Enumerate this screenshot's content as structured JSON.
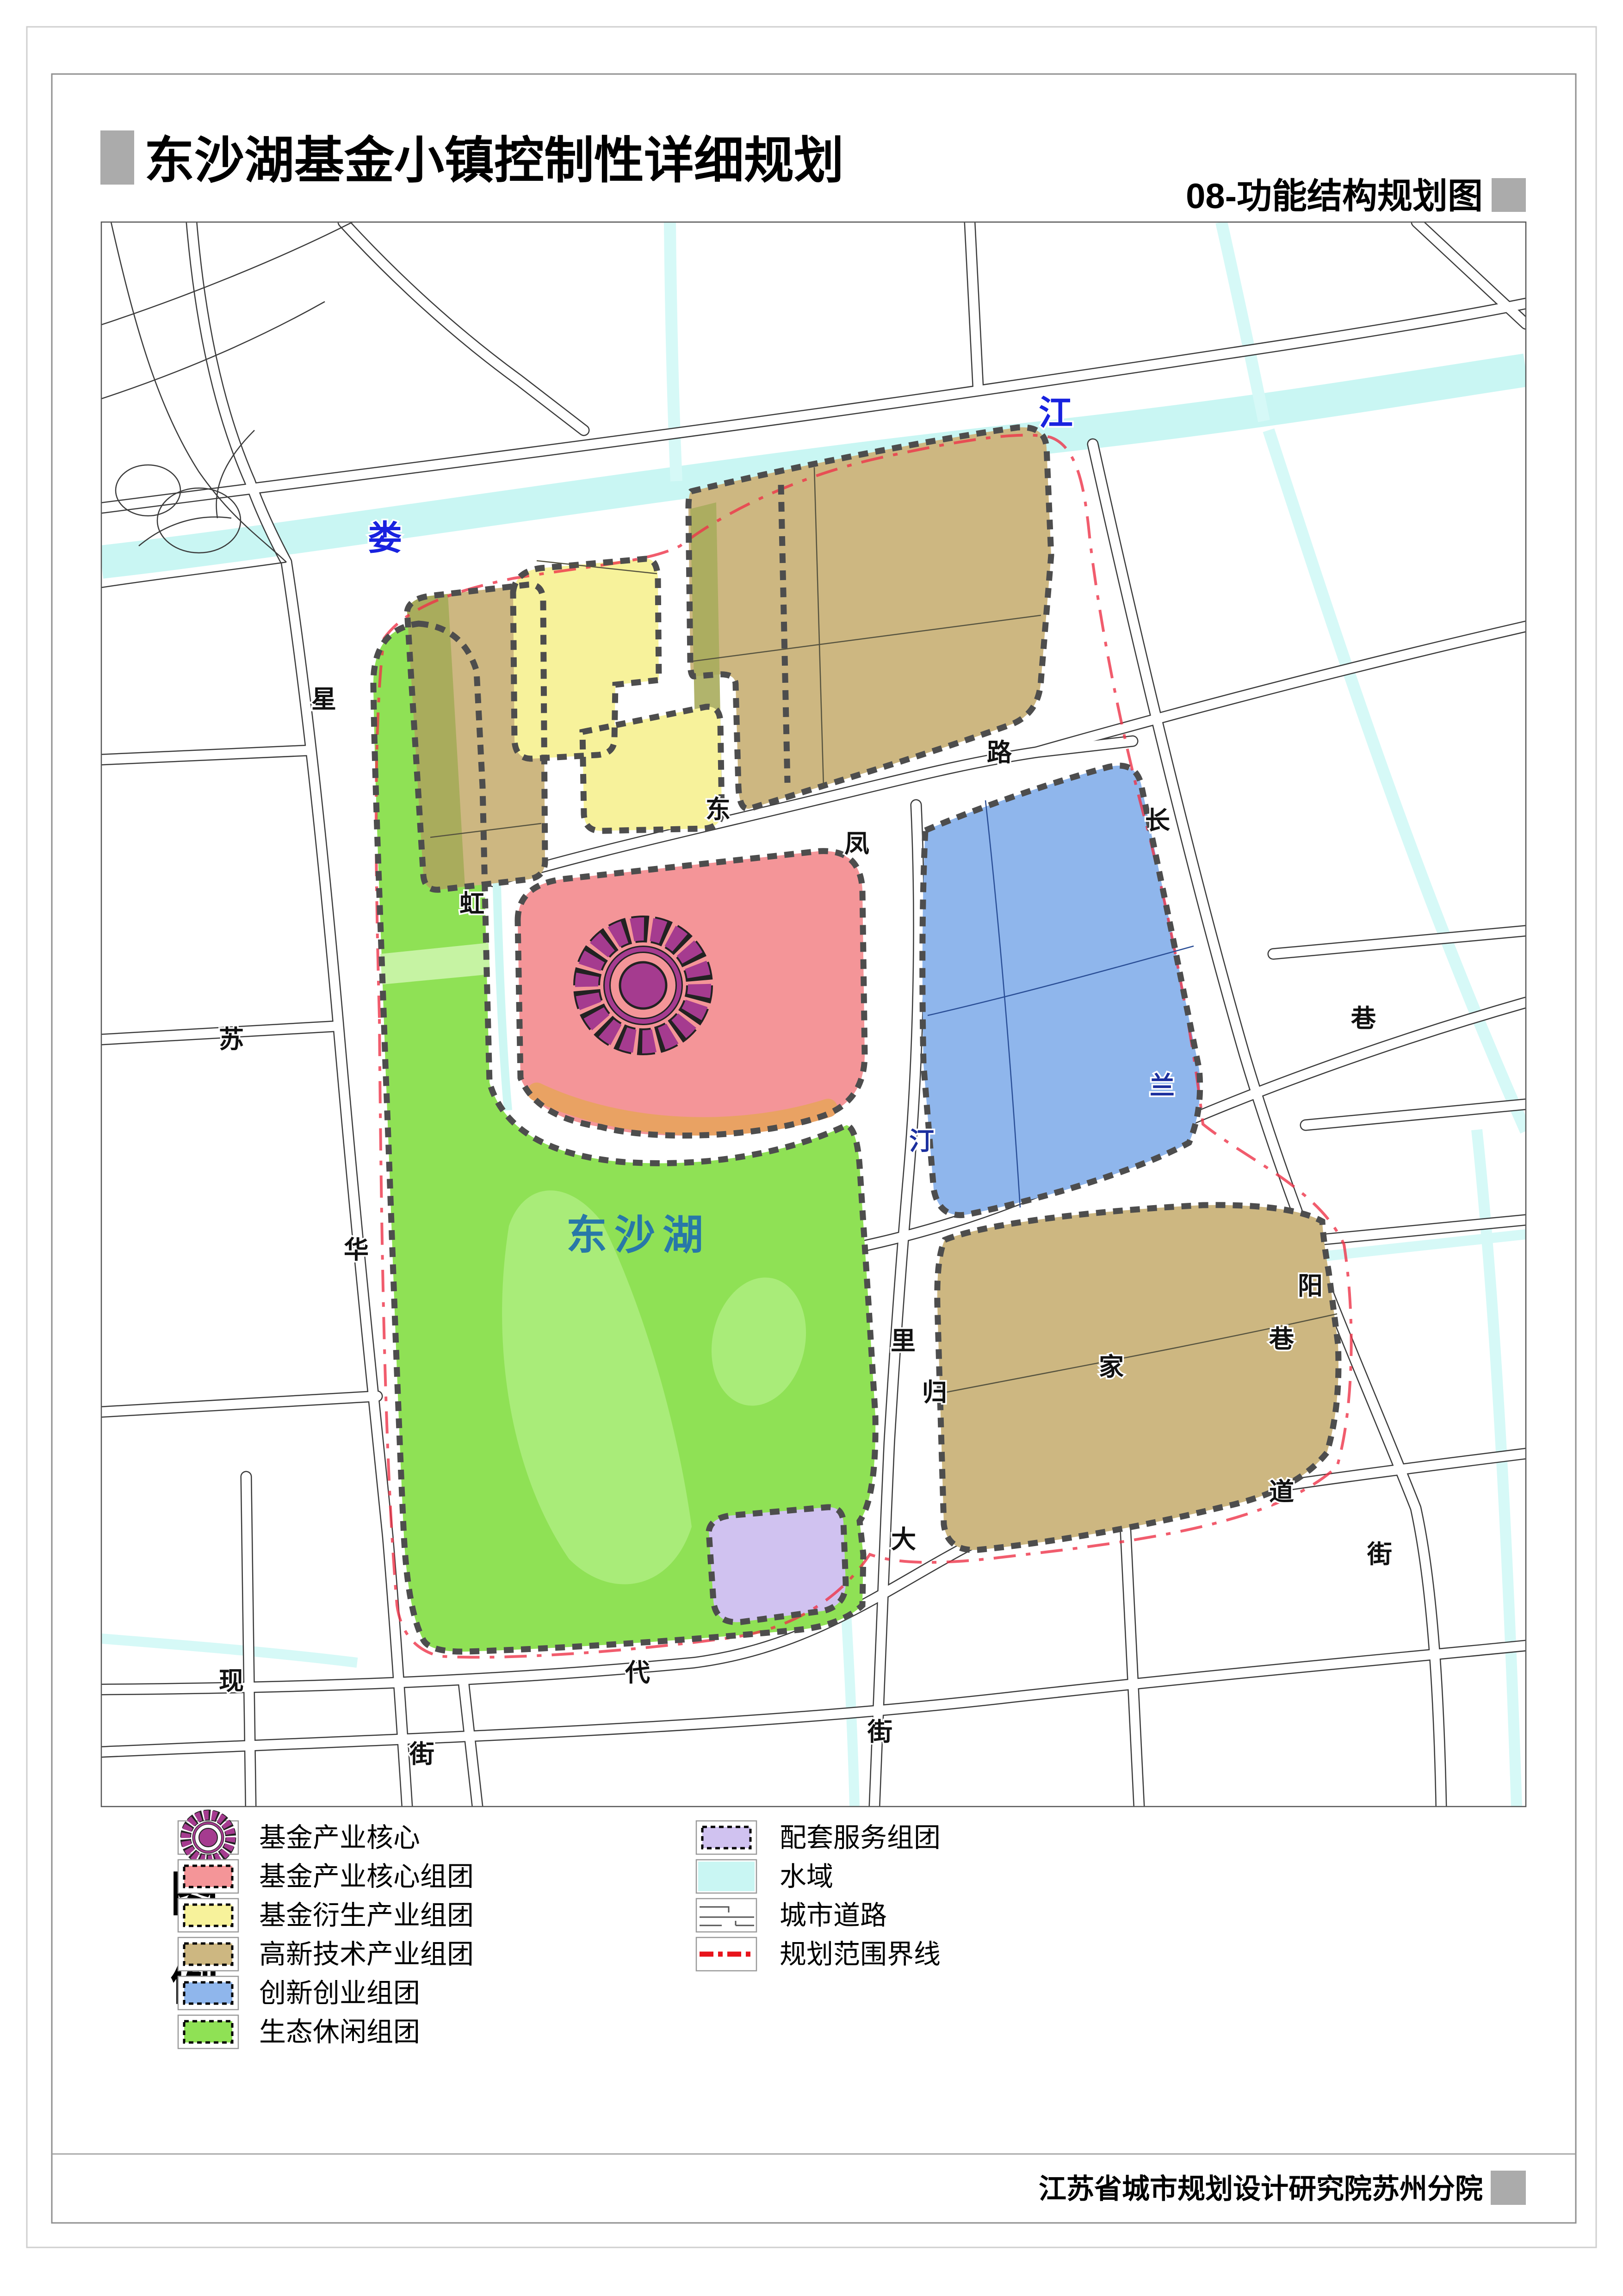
{
  "title": {
    "text": "东沙湖基金小镇控制性详细规划"
  },
  "subtitle": {
    "text": "08-功能结构规划图"
  },
  "footer": {
    "text": "江苏省城市规划设计研究院苏州分院"
  },
  "legend": {
    "heading": [
      "图",
      "例"
    ],
    "left": [
      {
        "label": "基金产业核心",
        "swatch": "flower"
      },
      {
        "label": "基金产业核心组团",
        "swatch": "pink"
      },
      {
        "label": "基金衍生产业组团",
        "swatch": "yellow"
      },
      {
        "label": "高新技术产业组团",
        "swatch": "tan"
      },
      {
        "label": "创新创业组团",
        "swatch": "blue"
      },
      {
        "label": "生态休闲组团",
        "swatch": "green"
      }
    ],
    "right": [
      {
        "label": "配套服务组团",
        "swatch": "purple"
      },
      {
        "label": "水域",
        "swatch": "water"
      },
      {
        "label": "城市道路",
        "swatch": "road"
      },
      {
        "label": "规划范围界线",
        "swatch": "boundary"
      }
    ]
  },
  "map": {
    "lake_label": "东沙湖",
    "river_labels": [
      {
        "t": "娄"
      },
      {
        "t": "江"
      }
    ],
    "street_labels": [
      {
        "t": "星"
      },
      {
        "t": "华"
      },
      {
        "t": "街"
      },
      {
        "t": "苏"
      },
      {
        "t": "虹"
      },
      {
        "t": "东"
      },
      {
        "t": "凤"
      },
      {
        "t": "路"
      },
      {
        "t": "长"
      },
      {
        "t": "阳"
      },
      {
        "t": "街"
      },
      {
        "t": "汀"
      },
      {
        "t": "兰"
      },
      {
        "t": "巷"
      },
      {
        "t": "里"
      },
      {
        "t": "归"
      },
      {
        "t": "家"
      },
      {
        "t": "巷"
      },
      {
        "t": "现"
      },
      {
        "t": "代"
      },
      {
        "t": "大"
      },
      {
        "t": "道"
      },
      {
        "t": "街"
      }
    ]
  },
  "colors": {
    "eco_green": "#8FE155",
    "eco_green_light": "#A9EC79",
    "eco_green_pale": "#C6F3A3",
    "hi_tech_tan": "#CDB781",
    "olive": "#A9AC5C",
    "fund_derive_yellow": "#F7F29B",
    "fund_core_pink": "#F49598",
    "core_orange": "#E9A263",
    "innovation_blue": "#8FB6EC",
    "service_purple": "#D0C2F0",
    "water_cyan": "#C9F6F3",
    "stream_cyan": "#D6F9F7",
    "flower_purple": "#A53B8F",
    "boundary_red": "#EE3348",
    "dashed_border_gray": "#4D4D4D",
    "road_line": "#3B3B3B",
    "lake_text": "#2878A8",
    "river_text": "#1822DF",
    "accent_gray": "#ABABAB"
  }
}
